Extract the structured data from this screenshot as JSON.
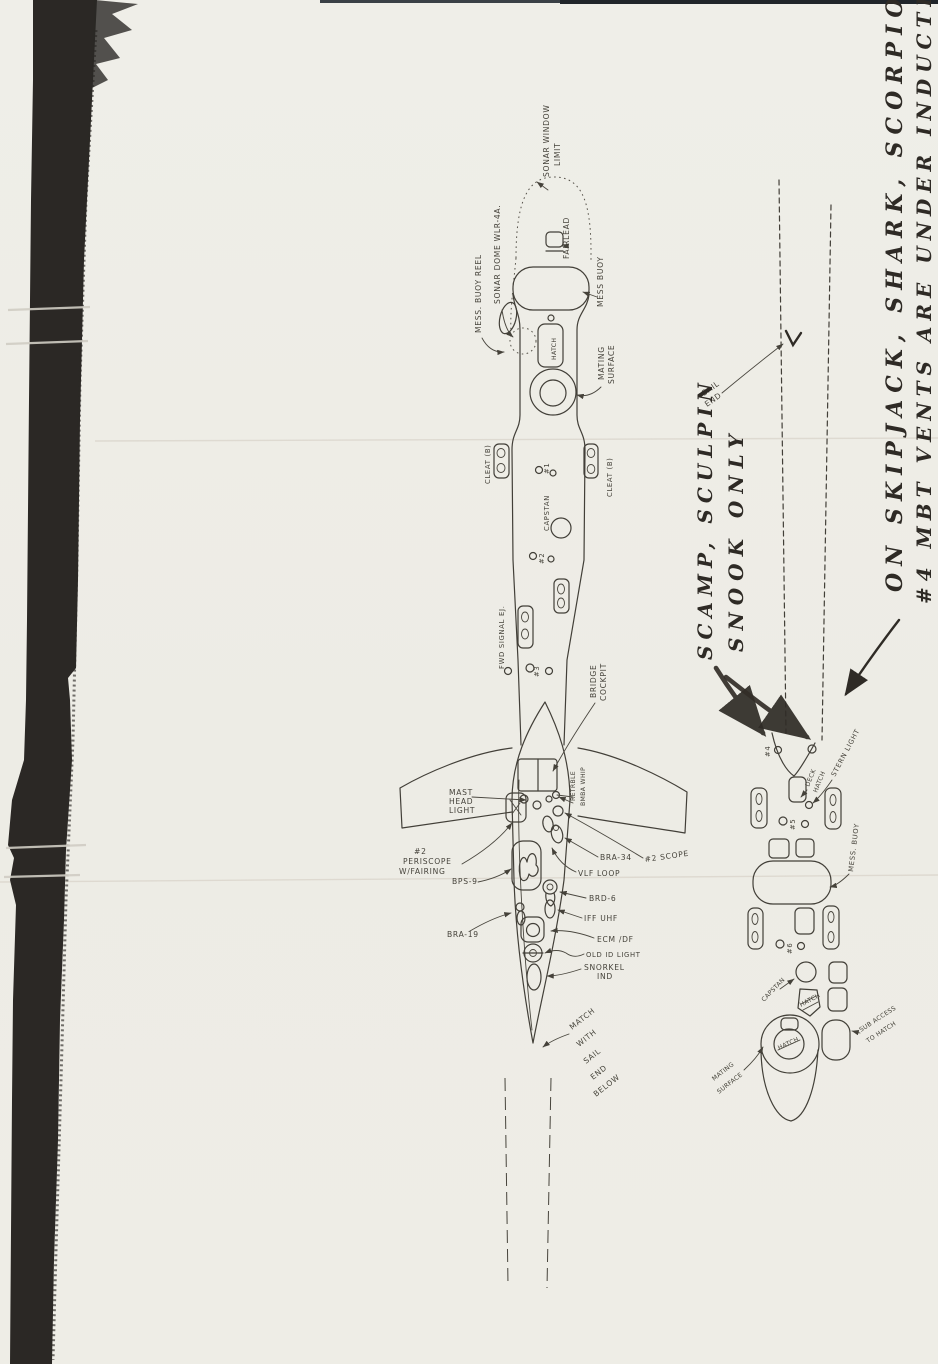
{
  "palette": {
    "paper": "#eeede6",
    "pencil_ink": "#423f38",
    "marker_ink": "#332e28",
    "photocopy_band": "#2b2825",
    "top_edge": "#20252a"
  },
  "handwritten_notes": {
    "class_note": [
      "ON SKIPJACK, SHARK, SCORPION",
      "#4 MBT VENTS ARE UNDER INDUCTION"
    ],
    "boat_note": [
      "SCAMP, SCULPIN",
      "SNOOK ONLY"
    ]
  },
  "main_view": {
    "bow_labels": {
      "sonar_window_limit": [
        "SONAR WINDOW",
        "LIMIT"
      ],
      "mess_buoy_reel": "MESS. BUOY REEL",
      "sonar_dome": "SONAR DOME WLR-4A.",
      "fairlead": "FAIRLEAD",
      "mess_buoy": "MESS BUOY",
      "hatch": "HATCH",
      "mating_surface": [
        "MATING",
        "SURFACE"
      ]
    },
    "deck_labels": {
      "cleat_left": "CLEAT (B)",
      "cleat_right": "CLEAT (B)",
      "vents_1": "#1",
      "capstan": "CAPSTAN",
      "vents_2": "#2",
      "fwd_signal_ejector": "FWD SIGNAL EJ.",
      "vents_3": "#3"
    },
    "sail_labels": {
      "bridge_cockpit": [
        "BRIDGE",
        "COCKPIT"
      ],
      "retractable_whip": [
        "RETRBLE",
        "BMBA WHIP"
      ],
      "mast_head_light": [
        "MAST",
        "HEAD",
        "LIGHT"
      ],
      "periscope": [
        "#2",
        "PERISCOPE",
        "W/FAIRING"
      ],
      "bps9": "BPS-9",
      "bra34": "BRA-34",
      "scope2": "#2 SCOPE",
      "vlf_loop": "VLF LOOP",
      "brd6": "BRD-6",
      "iff_uhf": "IFF UHF",
      "bra19": "BRA-19",
      "ecm_df": "ECM /DF",
      "old_id_light": "OLD ID LIGHT",
      "snorkel": [
        "SNORKEL",
        "IND"
      ],
      "match_note": [
        "MATCH",
        "WITH",
        "SAIL",
        "END",
        "BELOW"
      ]
    }
  },
  "aft_view": {
    "labels": {
      "sail_end": [
        "SAIL",
        "END"
      ],
      "vents_4": "#4",
      "deck_hatch": [
        "DECK",
        "HATCH"
      ],
      "stern_light": "STERN LIGHT",
      "vents_5": "#5",
      "mess_buoy": "MESS. BUOY",
      "vents_6": "#6",
      "capstan": "CAPSTAN",
      "hatch_small": "HATCH",
      "hatch_main": "HATCH",
      "mating_surface": [
        "MATING",
        "SURFACE"
      ],
      "sub_access": [
        "SUB ACCESS",
        "TO HATCH"
      ]
    }
  }
}
